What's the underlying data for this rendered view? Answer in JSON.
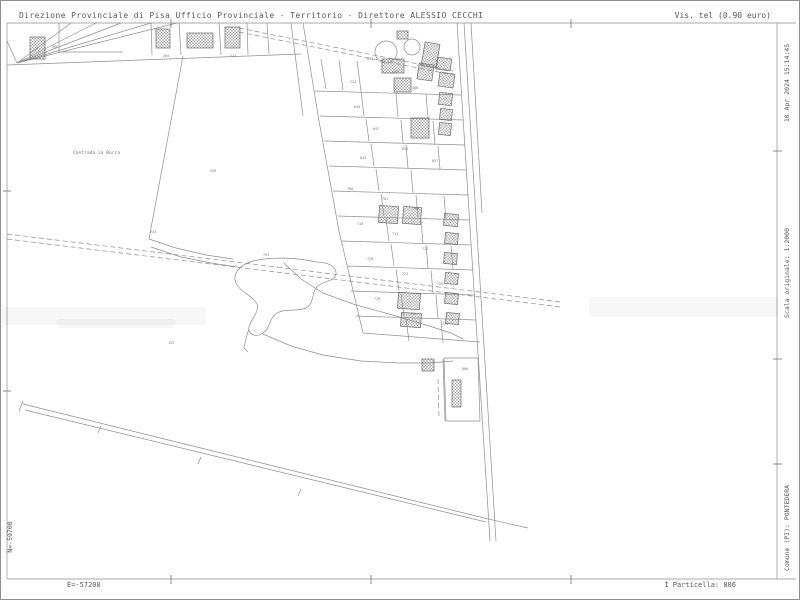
{
  "header": {
    "left": "Direzione Provinciale di Pisa  Ufficio Provinciale - Territorio - Direttore ALESSIO CECCHI",
    "right": "Vis. tel (0.90 euro)"
  },
  "margins": {
    "right_top": "10 Apr 2024 15:14:45",
    "right_middle": "Scala originale: 1:2000",
    "right_bottom": "Comune (PI): PONTEDERA",
    "left_bottom": "N=-59700",
    "bottom_left": "E=-57200",
    "bottom_right": "I Particella: 806"
  },
  "map": {
    "colors": {
      "line": "#8e8e8e",
      "tick": "#6f6f6f",
      "building_stroke": "#6a6a6a",
      "hatch": "#8b8b8b",
      "label": "#777777"
    },
    "locality": {
      "text": "Contrada la Borra",
      "x": 72,
      "y": 153,
      "size": 4.6
    },
    "labels": [
      [
        "743",
        149,
        232
      ],
      [
        "753",
        262,
        255
      ],
      [
        "229",
        209,
        171
      ],
      [
        "135",
        167,
        343
      ],
      [
        "806",
        461,
        369
      ],
      [
        "198",
        50,
        47
      ],
      [
        "204",
        162,
        56
      ],
      [
        "212",
        229,
        56
      ],
      [
        "638",
        366,
        59
      ],
      [
        "400",
        391,
        72
      ],
      [
        "224",
        349,
        82
      ],
      [
        "406",
        411,
        88
      ],
      [
        "640",
        353,
        107
      ],
      [
        "647",
        372,
        129
      ],
      [
        "651",
        401,
        149
      ],
      [
        "643",
        359,
        158
      ],
      [
        "657",
        431,
        161
      ],
      [
        "700",
        346,
        189
      ],
      [
        "702",
        381,
        199
      ],
      [
        "706",
        412,
        209
      ],
      [
        "710",
        356,
        224
      ],
      [
        "713",
        391,
        234
      ],
      [
        "717",
        421,
        249
      ],
      [
        "720",
        366,
        259
      ],
      [
        "723",
        401,
        274
      ],
      [
        "726",
        436,
        284
      ],
      [
        "729",
        373,
        299
      ],
      [
        "731",
        409,
        314
      ],
      [
        "734",
        441,
        324
      ]
    ],
    "segments": [
      [
        6,
        22,
        795,
        22
      ],
      [
        6,
        578,
        795,
        578
      ],
      [
        6,
        22,
        6,
        578
      ],
      [
        776,
        22,
        776,
        578
      ],
      [
        6,
        40,
        16,
        62
      ],
      [
        16,
        62,
        70,
        22
      ],
      [
        16,
        62,
        95,
        22
      ],
      [
        16,
        62,
        120,
        22
      ],
      [
        16,
        62,
        150,
        22
      ],
      [
        16,
        62,
        176,
        22
      ],
      [
        58,
        22,
        58,
        51
      ],
      [
        58,
        51,
        122,
        51
      ],
      [
        6,
        64,
        300,
        53
      ],
      [
        150,
        22,
        151,
        54
      ],
      [
        178,
        22,
        180,
        54
      ],
      [
        218,
        22,
        220,
        54
      ],
      [
        246,
        22,
        247,
        54
      ],
      [
        266,
        22,
        268,
        53
      ],
      [
        182,
        55,
        148,
        238
      ],
      [
        302,
        22,
        318,
        120
      ],
      [
        318,
        120,
        338,
        230
      ],
      [
        338,
        230,
        362,
        332
      ],
      [
        290,
        22,
        302,
        115
      ],
      [
        362,
        332,
        479,
        341
      ],
      [
        456,
        22,
        489,
        540
      ],
      [
        463,
        22,
        495,
        540
      ],
      [
        470,
        22,
        481,
        212
      ],
      [
        483,
        517,
        527,
        527
      ],
      [
        22,
        403,
        483,
        517
      ],
      [
        24,
        409,
        485,
        521
      ],
      [
        22,
        400,
        18,
        410
      ],
      [
        100,
        425,
        97,
        432
      ],
      [
        200,
        456,
        197,
        463
      ],
      [
        300,
        488,
        297,
        495
      ],
      [
        443,
        357,
        477,
        357
      ],
      [
        477,
        357,
        479,
        420
      ],
      [
        479,
        420,
        445,
        420
      ],
      [
        445,
        420,
        443,
        357
      ],
      [
        442,
        358,
        444,
        420
      ],
      [
        314,
        90,
        460,
        94
      ],
      [
        319,
        115,
        462,
        119
      ],
      [
        323,
        140,
        464,
        144
      ],
      [
        328,
        165,
        465,
        169
      ],
      [
        332,
        190,
        467,
        194
      ],
      [
        337,
        215,
        468,
        219
      ],
      [
        341,
        240,
        470,
        244
      ],
      [
        346,
        265,
        472,
        269
      ],
      [
        350,
        290,
        473,
        294
      ],
      [
        355,
        315,
        475,
        319
      ],
      [
        320,
        58,
        325,
        88
      ],
      [
        338,
        59,
        342,
        89
      ],
      [
        356,
        60,
        360,
        90
      ],
      [
        360,
        90,
        363,
        115
      ],
      [
        395,
        92,
        397,
        116
      ],
      [
        425,
        93,
        427,
        117
      ],
      [
        365,
        118,
        368,
        140
      ],
      [
        400,
        119,
        402,
        142
      ],
      [
        432,
        120,
        434,
        144
      ],
      [
        370,
        143,
        373,
        165
      ],
      [
        405,
        144,
        407,
        167
      ],
      [
        437,
        145,
        439,
        168
      ],
      [
        375,
        168,
        378,
        190
      ],
      [
        410,
        169,
        412,
        192
      ],
      [
        380,
        193,
        383,
        215
      ],
      [
        415,
        194,
        417,
        217
      ],
      [
        443,
        195,
        445,
        218
      ],
      [
        385,
        218,
        388,
        240
      ],
      [
        420,
        219,
        422,
        242
      ],
      [
        390,
        243,
        393,
        265
      ],
      [
        425,
        244,
        427,
        267
      ],
      [
        450,
        245,
        452,
        268
      ],
      [
        395,
        268,
        398,
        290
      ],
      [
        430,
        269,
        432,
        292
      ],
      [
        400,
        293,
        403,
        315
      ],
      [
        435,
        294,
        437,
        317
      ],
      [
        405,
        318,
        408,
        340
      ],
      [
        440,
        319,
        442,
        342
      ]
    ],
    "dashed": [
      [
        6,
        233,
        560,
        301
      ],
      [
        6,
        238,
        560,
        306
      ],
      [
        238,
        27,
        452,
        70
      ],
      [
        238,
        31,
        452,
        74
      ],
      [
        437,
        378,
        438,
        417
      ]
    ],
    "polylines": [
      [
        148,
        238,
        175,
        247,
        205,
        254,
        232,
        258
      ],
      [
        150,
        246,
        180,
        256,
        210,
        262,
        236,
        266
      ],
      [
        283,
        262,
        300,
        278,
        322,
        292,
        352,
        303,
        388,
        313,
        422,
        323,
        450,
        332,
        462,
        338
      ],
      [
        262,
        333,
        290,
        345,
        322,
        354,
        360,
        360,
        398,
        362,
        428,
        362,
        452,
        360
      ]
    ],
    "paths": [
      "M252,260 C238,264 230,274 236,284 C241,292 252,295 256,303 C259,310 250,318 248,326 C246,333 255,337 262,332 C270,326 268,317 276,312 C285,307 296,311 305,307 C314,302 310,291 317,285 C324,279 333,281 335,273 C336,265 326,261 315,261 C295,256 268,256 252,260 Z",
      "M248,328 C245,336 244,342 243,347 L247,351"
    ],
    "buildings": [
      [
        29,
        36,
        15,
        22,
        0
      ],
      [
        155,
        28,
        14,
        19,
        0
      ],
      [
        186,
        32,
        26,
        15,
        0
      ],
      [
        224,
        26,
        15,
        21,
        0
      ],
      [
        396,
        30,
        11,
        8,
        0
      ],
      [
        422,
        42,
        15,
        24,
        10
      ],
      [
        381,
        58,
        22,
        14,
        0
      ],
      [
        436,
        57,
        14,
        12,
        8
      ],
      [
        417,
        63,
        15,
        16,
        8
      ],
      [
        438,
        72,
        15,
        14,
        8
      ],
      [
        393,
        77,
        17,
        14,
        0
      ],
      [
        438,
        92,
        13,
        12,
        6
      ],
      [
        439,
        108,
        12,
        11,
        6
      ],
      [
        410,
        117,
        18,
        20,
        0
      ],
      [
        438,
        122,
        12,
        12,
        6
      ],
      [
        378,
        205,
        19,
        17,
        4
      ],
      [
        402,
        206,
        18,
        17,
        4
      ],
      [
        443,
        213,
        14,
        12,
        6
      ],
      [
        444,
        232,
        13,
        11,
        6
      ],
      [
        443,
        252,
        13,
        11,
        6
      ],
      [
        444,
        272,
        13,
        11,
        6
      ],
      [
        444,
        292,
        13,
        11,
        6
      ],
      [
        445,
        312,
        13,
        11,
        6
      ],
      [
        397,
        292,
        22,
        16,
        4
      ],
      [
        400,
        312,
        20,
        14,
        4
      ],
      [
        421,
        358,
        12,
        12,
        0
      ],
      [
        451,
        379,
        9,
        27,
        0
      ]
    ],
    "circles": [
      [
        385,
        51,
        11
      ],
      [
        411,
        46,
        8
      ]
    ],
    "ticks": [
      [
        170,
        18,
        170,
        27
      ],
      [
        370,
        18,
        370,
        27
      ],
      [
        570,
        18,
        570,
        27
      ],
      [
        170,
        574,
        170,
        583
      ],
      [
        370,
        574,
        370,
        583
      ],
      [
        570,
        574,
        570,
        583
      ],
      [
        2,
        190,
        10,
        190
      ],
      [
        2,
        390,
        10,
        390
      ],
      [
        772,
        150,
        781,
        150
      ],
      [
        772,
        358,
        781,
        358
      ],
      [
        772,
        463,
        781,
        463
      ]
    ],
    "smudges": [
      [
        0,
        306,
        205,
        18
      ],
      [
        588,
        296,
        190,
        20
      ],
      [
        55,
        318,
        120,
        9
      ]
    ]
  }
}
